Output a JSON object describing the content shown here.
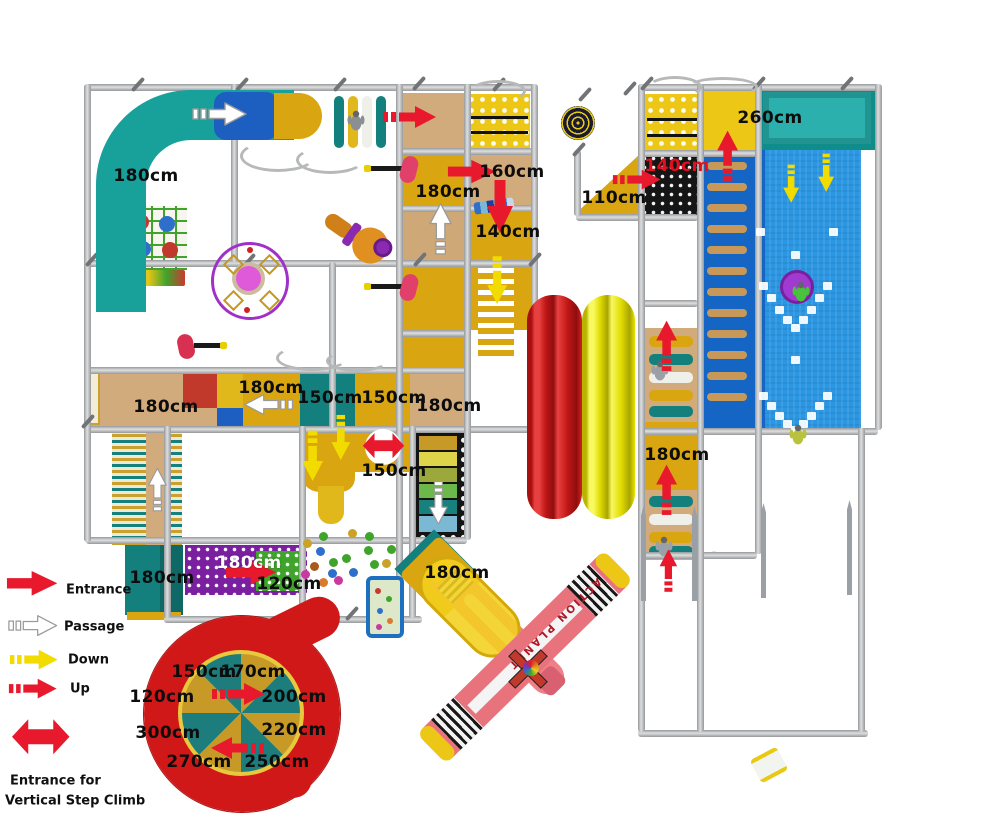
{
  "legend": {
    "items": [
      {
        "label": "Entrance",
        "type": "entrance"
      },
      {
        "label": "Passage",
        "type": "passage"
      },
      {
        "label": "Down",
        "type": "down"
      },
      {
        "label": "Up",
        "type": "up"
      }
    ],
    "note_line1": "Entrance for",
    "note_line2": "Vertical Step Climb"
  },
  "plane": {
    "wing_text": "ACTION PLANET"
  },
  "colors": {
    "arrow_red": "#e8192c",
    "arrow_yellow": "#f2dc00",
    "arrow_white": "#ffffff",
    "arrow_outline": "#9a9a9a"
  },
  "measurements": [
    {
      "text": "180cm",
      "x": 146,
      "y": 176
    },
    {
      "text": "180cm",
      "x": 448,
      "y": 192
    },
    {
      "text": "160cm",
      "x": 512,
      "y": 172
    },
    {
      "text": "140cm",
      "x": 508,
      "y": 232
    },
    {
      "text": "140cm",
      "x": 677,
      "y": 166,
      "variant": "red"
    },
    {
      "text": "110cm",
      "x": 614,
      "y": 198
    },
    {
      "text": "260cm",
      "x": 770,
      "y": 118
    },
    {
      "text": "180cm",
      "x": 166,
      "y": 407
    },
    {
      "text": "180cm",
      "x": 271,
      "y": 388
    },
    {
      "text": "150cm",
      "x": 330,
      "y": 398
    },
    {
      "text": "150cm",
      "x": 394,
      "y": 398
    },
    {
      "text": "180cm",
      "x": 449,
      "y": 406
    },
    {
      "text": "150cm",
      "x": 394,
      "y": 471
    },
    {
      "text": "180cm",
      "x": 162,
      "y": 578
    },
    {
      "text": "180cm",
      "x": 249,
      "y": 563,
      "variant": "white"
    },
    {
      "text": "120cm",
      "x": 289,
      "y": 584
    },
    {
      "text": "180cm",
      "x": 457,
      "y": 573
    },
    {
      "text": "180cm",
      "x": 677,
      "y": 455
    },
    {
      "text": "150cm",
      "x": 204,
      "y": 672
    },
    {
      "text": "170cm",
      "x": 253,
      "y": 672
    },
    {
      "text": "120cm",
      "x": 162,
      "y": 697
    },
    {
      "text": "200cm",
      "x": 294,
      "y": 697
    },
    {
      "text": "300cm",
      "x": 168,
      "y": 733
    },
    {
      "text": "220cm",
      "x": 294,
      "y": 730
    },
    {
      "text": "270cm",
      "x": 199,
      "y": 762
    },
    {
      "text": "250cm",
      "x": 277,
      "y": 762
    }
  ],
  "arrows": [
    {
      "type": "passage",
      "dir": "right",
      "x": 220,
      "y": 114,
      "s": 1.0
    },
    {
      "type": "up",
      "dir": "right",
      "x": 410,
      "y": 117,
      "s": 1.0
    },
    {
      "type": "entrance",
      "dir": "right",
      "x": 472,
      "y": 172,
      "s": 0.9
    },
    {
      "type": "entrance",
      "dir": "down",
      "x": 500,
      "y": 207,
      "s": 1.0
    },
    {
      "type": "passage",
      "dir": "up",
      "x": 441,
      "y": 228,
      "s": 0.95
    },
    {
      "type": "down",
      "dir": "down",
      "x": 497,
      "y": 281,
      "s": 0.9
    },
    {
      "type": "up",
      "dir": "right",
      "x": 637,
      "y": 180,
      "s": 0.9
    },
    {
      "type": "up",
      "dir": "up",
      "x": 728,
      "y": 155,
      "s": 0.95
    },
    {
      "type": "down",
      "dir": "down",
      "x": 791,
      "y": 184,
      "s": 0.72
    },
    {
      "type": "down",
      "dir": "down",
      "x": 826,
      "y": 173,
      "s": 0.72
    },
    {
      "type": "up",
      "dir": "up",
      "x": 667,
      "y": 345,
      "s": 0.95
    },
    {
      "type": "up",
      "dir": "up",
      "x": 667,
      "y": 489,
      "s": 0.95
    },
    {
      "type": "up",
      "dir": "up",
      "x": 668,
      "y": 570,
      "s": 0.8
    },
    {
      "type": "down",
      "dir": "down",
      "x": 313,
      "y": 456,
      "s": 0.95
    },
    {
      "type": "down",
      "dir": "down",
      "x": 341,
      "y": 438,
      "s": 0.85
    },
    {
      "type": "vclimb",
      "dir": "up",
      "x": 383,
      "y": 446,
      "s": 0.9
    },
    {
      "type": "passage",
      "dir": "down",
      "x": 438,
      "y": 503,
      "s": 0.8
    },
    {
      "type": "entrance",
      "dir": "right",
      "x": 252,
      "y": 572,
      "s": 0.95
    },
    {
      "type": "up",
      "dir": "right",
      "x": 239,
      "y": 694,
      "s": 1.0
    },
    {
      "type": "up",
      "dir": "left",
      "x": 237,
      "y": 748,
      "s": 1.0
    },
    {
      "type": "passage",
      "dir": "left",
      "x": 268,
      "y": 405,
      "s": 0.9
    },
    {
      "type": "passage",
      "dir": "up",
      "x": 157,
      "y": 489,
      "s": 0.8
    }
  ],
  "balls": [
    [
      307,
      543,
      "#c9a227"
    ],
    [
      323,
      536,
      "#3fa32c"
    ],
    [
      352,
      533,
      "#c9a227"
    ],
    [
      369,
      536,
      "#3fa32c"
    ],
    [
      320,
      551,
      "#2e6fc9"
    ],
    [
      333,
      562,
      "#3fa32c"
    ],
    [
      346,
      558,
      "#3fa32c"
    ],
    [
      368,
      550,
      "#3fa32c"
    ],
    [
      314,
      566,
      "#a85a1e"
    ],
    [
      305,
      574,
      "#c93a9e"
    ],
    [
      332,
      573,
      "#2e6fc9"
    ],
    [
      353,
      572,
      "#2e6fc9"
    ],
    [
      323,
      582,
      "#d97b2e"
    ],
    [
      338,
      580,
      "#c93a9e"
    ],
    [
      374,
      564,
      "#3fa32c"
    ],
    [
      391,
      549,
      "#3fa32c"
    ],
    [
      386,
      563,
      "#c9a227"
    ]
  ],
  "wall_steps": [
    [
      763,
      286
    ],
    [
      771,
      298
    ],
    [
      779,
      310
    ],
    [
      787,
      320
    ],
    [
      795,
      328
    ],
    [
      803,
      320
    ],
    [
      811,
      310
    ],
    [
      819,
      298
    ],
    [
      827,
      286
    ],
    [
      763,
      396
    ],
    [
      771,
      406
    ],
    [
      779,
      416
    ],
    [
      787,
      424
    ],
    [
      795,
      430
    ],
    [
      803,
      424
    ],
    [
      811,
      416
    ],
    [
      819,
      406
    ],
    [
      827,
      396
    ],
    [
      760,
      232
    ],
    [
      833,
      232
    ],
    [
      795,
      255
    ],
    [
      795,
      360
    ]
  ]
}
